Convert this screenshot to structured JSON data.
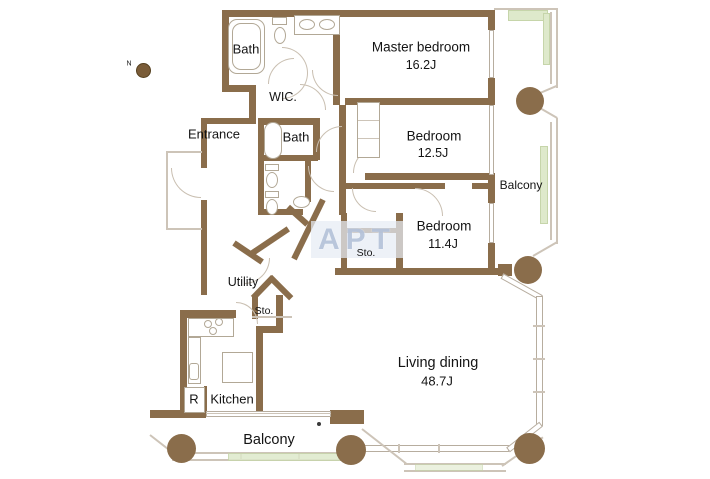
{
  "plan": {
    "watermark": "APT",
    "compass": {
      "label": "N"
    },
    "rooms": {
      "bath1": {
        "name": "Bath"
      },
      "master_bedroom": {
        "name": "Master bedroom",
        "size": "16.2J"
      },
      "wic": {
        "name": "WIC."
      },
      "entrance": {
        "name": "Entrance"
      },
      "bath2": {
        "name": "Bath"
      },
      "bedroom2": {
        "name": "Bedroom",
        "size": "12.5J"
      },
      "bedroom3": {
        "name": "Bedroom",
        "size": "11.4J"
      },
      "storage1": {
        "name": "Sto."
      },
      "utility": {
        "name": "Utility"
      },
      "storage2": {
        "name": "Sto."
      },
      "kitchen": {
        "name": "Kitchen"
      },
      "refrigerator": {
        "name": "R"
      },
      "living_dining": {
        "name": "Living dining",
        "size": "48.7J"
      },
      "balcony_right": {
        "name": "Balcony"
      },
      "balcony_bottom": {
        "name": "Balcony"
      }
    },
    "colors": {
      "wall": "#8a6d4b",
      "railing": "#cdc4b8",
      "planter": "#dee9cb",
      "watermark_text": "#b4c2d9"
    }
  }
}
